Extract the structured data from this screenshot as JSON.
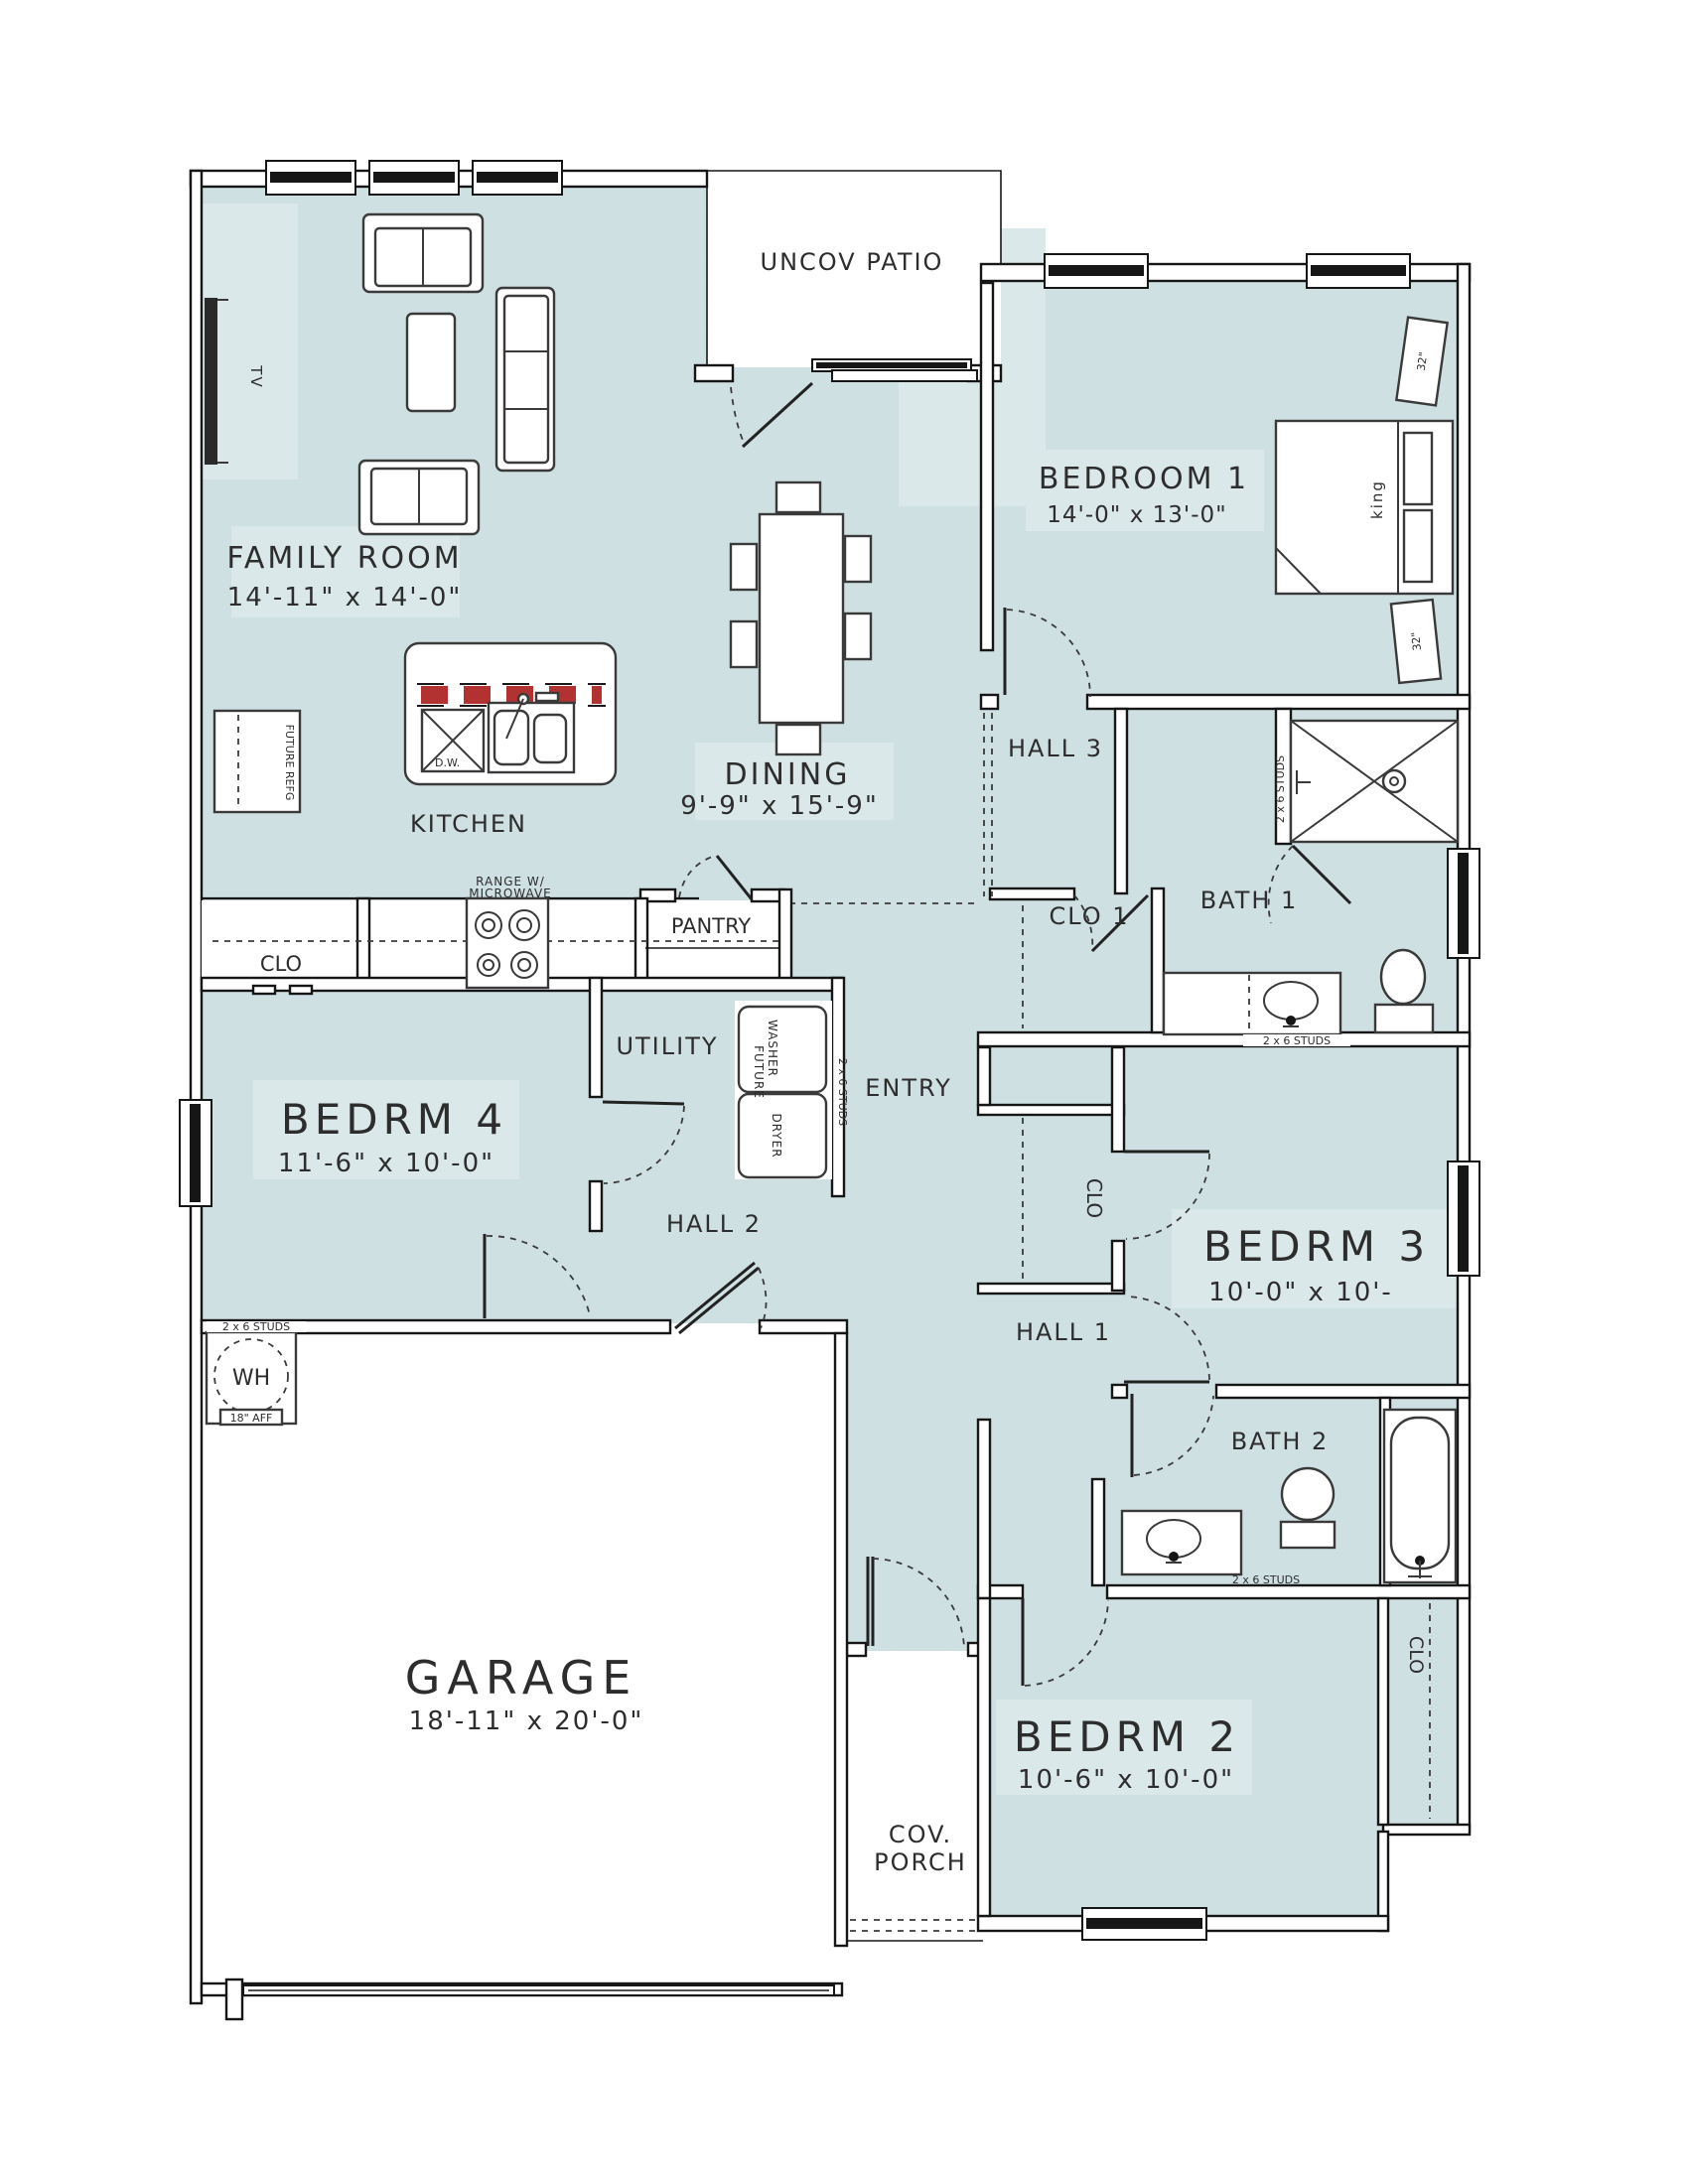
{
  "rooms": {
    "family_room": {
      "name": "FAMILY ROOM",
      "dims": "14'-11\" x 14'-0\""
    },
    "uncov_patio": {
      "name": "UNCOV PATIO"
    },
    "bedroom1": {
      "name": "BEDROOM 1",
      "dims": "14'-0\" x 13'-0\""
    },
    "dining": {
      "name": "DINING",
      "dims": "9'-9\" x 15'-9\""
    },
    "kitchen": {
      "name": "KITCHEN"
    },
    "hall3": {
      "name": "HALL 3"
    },
    "bath1": {
      "name": "BATH 1"
    },
    "clo1": {
      "name": "CLO 1"
    },
    "pantry": {
      "name": "PANTRY"
    },
    "clo_left": {
      "name": "CLO"
    },
    "bedrm4": {
      "name": "BEDRM 4",
      "dims": "11'-6\" x 10'-0\""
    },
    "utility": {
      "name": "UTILITY"
    },
    "entry": {
      "name": "ENTRY"
    },
    "hall2": {
      "name": "HALL 2"
    },
    "clo_mid": {
      "name": "CLO"
    },
    "bedrm3": {
      "name": "BEDRM 3",
      "dims": "10'-0\" x 10'-"
    },
    "hall1": {
      "name": "HALL 1"
    },
    "bath2": {
      "name": "BATH 2"
    },
    "garage": {
      "name": "GARAGE",
      "dims": "18'-11\" x 20'-0\""
    },
    "cov_porch": {
      "line1": "COV.",
      "line2": "PORCH"
    },
    "bedrm2": {
      "name": "BEDRM 2",
      "dims": "10'-6\" x 10'-0\""
    },
    "clo_bedrm2": {
      "name": "CLO"
    }
  },
  "annotations": {
    "tv": "TV",
    "king": "king",
    "nightstand_size": "32\"",
    "future_refg": "FUTURE REFG",
    "dishwasher": "D.W.",
    "range_line1": "RANGE W/",
    "range_line2": "MICROWAVE",
    "washer_line1": "WASHER",
    "washer_line2": "FUTURE",
    "dryer": "DRYER",
    "studs": "2 x 6 STUDS",
    "water_heater": "WH",
    "wh_height": "18\" AFF"
  },
  "colors": {
    "room_fill": "#cfe0e3",
    "label_panel": "#dae8ea",
    "wall": "#161616",
    "counter_red_dash": "#b23232",
    "text": "#2d2d2d"
  }
}
